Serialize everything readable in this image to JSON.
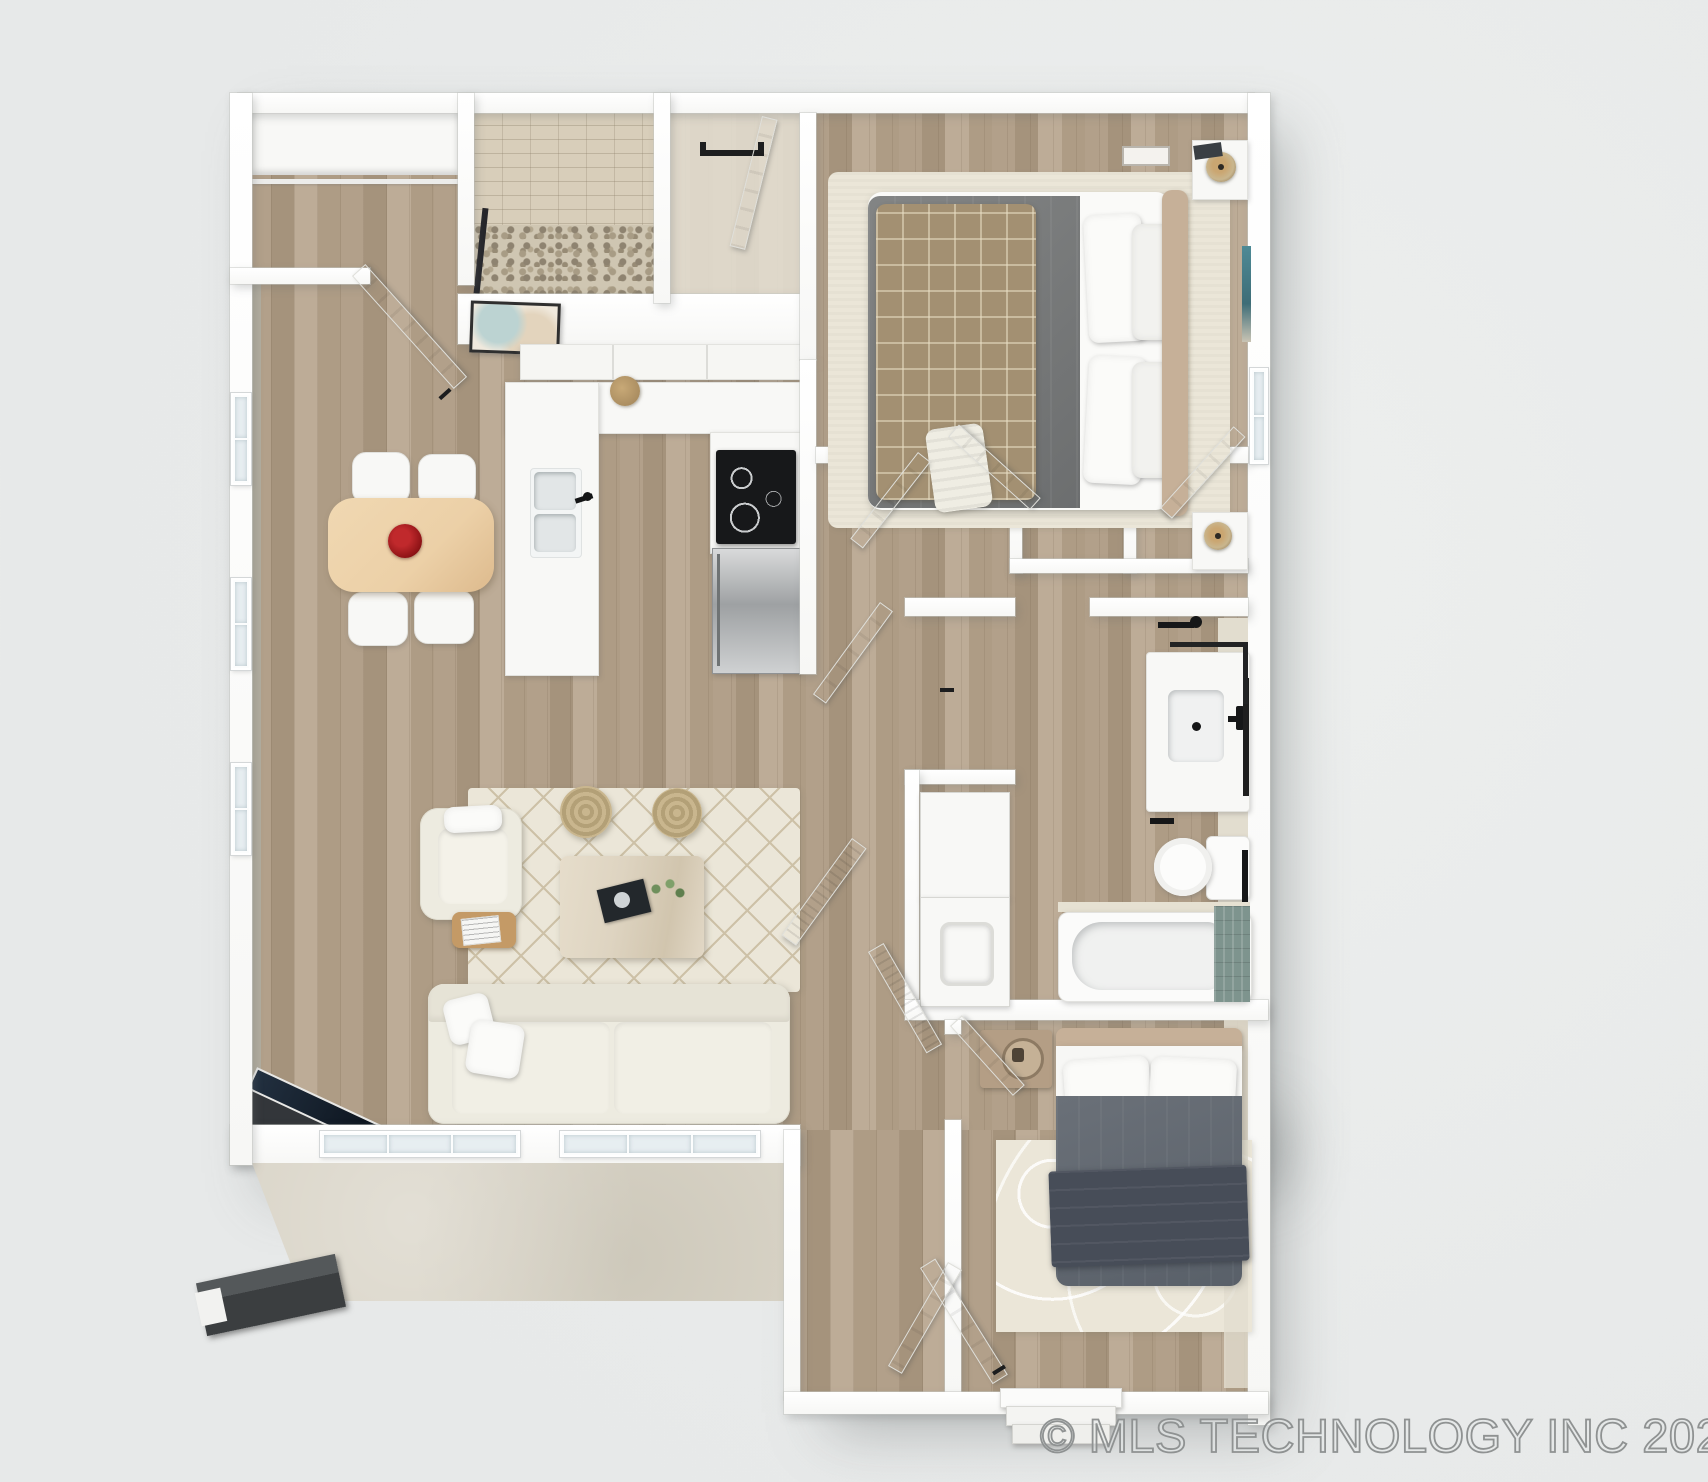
{
  "watermark": {
    "text": "© MLS TECHNOLOGY INC 2026"
  },
  "palette": {
    "bg": "#e7e9e9",
    "bg_hi": "#edefee",
    "pane": "#e7eef1",
    "wood_mid": "#b2a08a",
    "wood_dark": "#a5937c",
    "wood_light": "#bdac97",
    "wood_mid2": "#ae9c85",
    "concrete": "#d9d4c7",
    "sage": "#b0aea1",
    "wall_face": "#e2ddcf",
    "rug_cream": "#ebe6d8",
    "rug_line": "#cdc1a7",
    "sofa_cream": "#edebe0",
    "table_tan": "#ecd0a7",
    "flower_red": "#8e1316",
    "duvet_gray_a": "#838585",
    "duvet_gray_b": "#6c6e6f",
    "plaid_tan": "#a39072",
    "headboard_tan": "#c6b098",
    "duvet_slate_a": "#6a7078",
    "duvet_slate_b": "#596069",
    "throw_slate": "#474d58",
    "rattan": "#c9b68e",
    "travertine": "#ded4c1",
    "stainless_light": "#d9dadb",
    "stainless_dark": "#9ea1a3",
    "appliance_black": "#17181a",
    "tile_teal": "#7e948e",
    "art_teal": "#4d8a96",
    "pebble_base": "#cfc6b2",
    "tile_wall": "#d8ceba",
    "watermark_stroke": "#8f9292",
    "watermark_fill": "rgba(228,231,231,0.55)"
  }
}
